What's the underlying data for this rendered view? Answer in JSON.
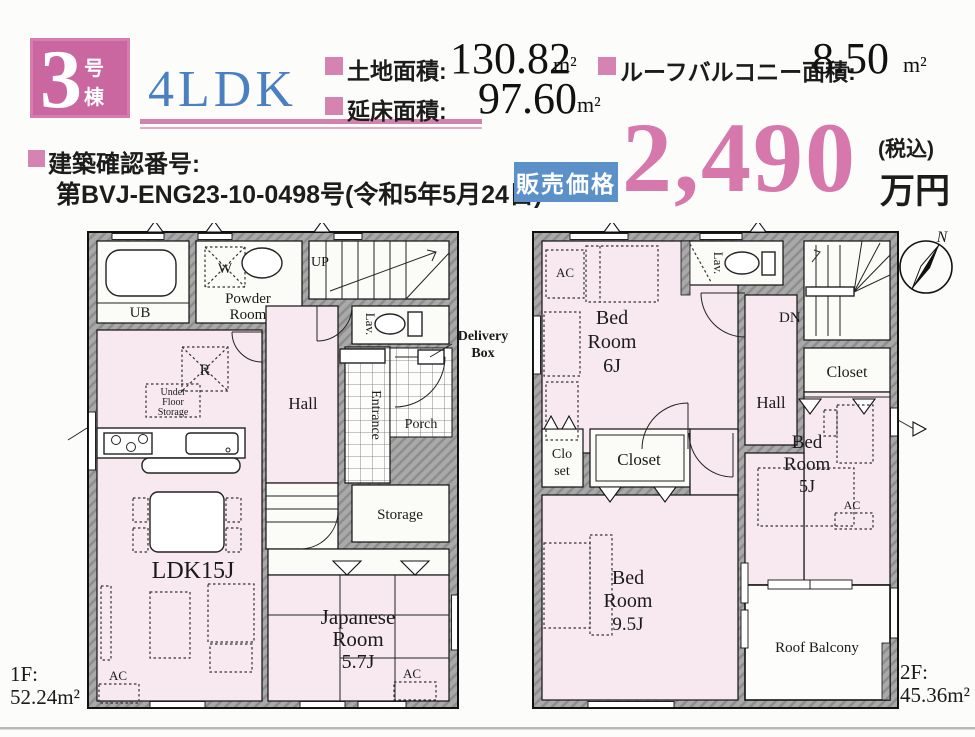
{
  "header": {
    "unit_number": "3",
    "unit_suffix": "号棟",
    "layout": "4LDK",
    "land_area_label": "土地面積:",
    "land_area_value": "130.82",
    "land_area_unit": "m²",
    "floor_area_label": "延床面積:",
    "floor_area_value": "97.60",
    "floor_area_unit": "m²",
    "roof_balcony_label": "ルーフバルコニー面積:",
    "roof_balcony_value": "8.50",
    "roof_balcony_unit": "m²",
    "confirmation_label": "建築確認番号:",
    "confirmation_value": "第BVJ-ENG23-10-0498号(令和5年5月24日)",
    "price_badge": "販売価格",
    "price_value": "2,490",
    "price_tax": "(税込)",
    "price_unit": "万円"
  },
  "floor1": {
    "floor_label": "1F:",
    "floor_area": "52.24m²",
    "ub": "UB",
    "washer": "W",
    "powder_line1": "Powder",
    "powder_line2": "Room",
    "up": "UP",
    "lav": "Lav.",
    "delivery_line1": "Delivery",
    "delivery_line2": "Box",
    "hall": "Hall",
    "entrance": "Entrance",
    "porch": "Porch",
    "fridge": "R",
    "ufs_line1": "Under",
    "ufs_line2": "Floor",
    "ufs_line3": "Storage",
    "storage": "Storage",
    "ldk": "LDK15J",
    "ac_ldk": "AC",
    "jp_line1": "Japanese",
    "jp_line2": "Room",
    "jp_line3": "5.7J",
    "ac_jp": "AC"
  },
  "floor2": {
    "floor_label": "2F:",
    "floor_area": "45.36m²",
    "ac_bed6": "AC",
    "bed6_line1": "Bed",
    "bed6_line2": "Room",
    "bed6_line3": "6J",
    "lav": "Lav.",
    "dn": "DN",
    "hall": "Hall",
    "closet_right": "Closet",
    "bed5_line1": "Bed",
    "bed5_line2": "Room",
    "bed5_line3": "5J",
    "ac_bed5": "AC",
    "closet_small_line1": "Clo",
    "closet_small_line2": "set",
    "closet_mid": "Closet",
    "bed95_line1": "Bed",
    "bed95_line2": "Room",
    "bed95_line3": "9.5J",
    "roof_balcony": "Roof Balcony"
  },
  "compass": {
    "north_label": "N"
  },
  "colors": {
    "accent_pink": "#cb67a0",
    "price_pink": "#d678ab",
    "layout_blue": "#4a7fc1",
    "badge_blue": "#5c90c8",
    "room_pink": "#f7e9ef",
    "wall_gray": "#a9a9a9"
  }
}
